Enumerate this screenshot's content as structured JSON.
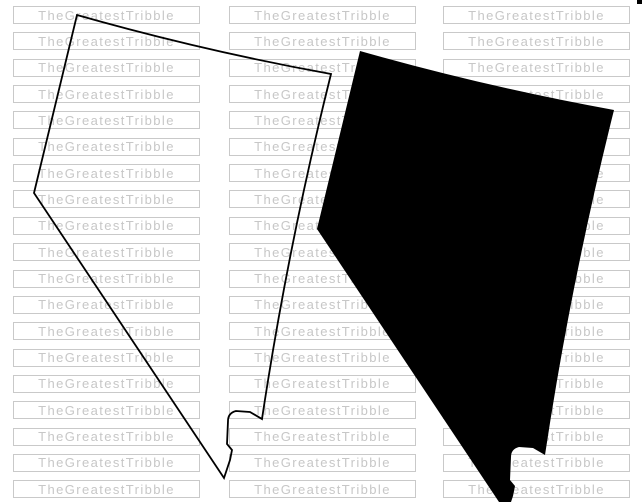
{
  "canvas": {
    "width": 642,
    "height": 502,
    "background_color": "#ffffff"
  },
  "watermark": {
    "text": "TheGreatestTribble",
    "text_color": "#c7c7c7",
    "border_color": "#c9c9c9",
    "rows": 19,
    "cols": 3,
    "col_x": [
      13,
      229,
      443
    ],
    "row_start_y": 6,
    "row_pitch": 26.35,
    "box_width": 185,
    "box_height": 16
  },
  "maps": {
    "shape_name": "nevada-state-map",
    "path": "M77,15 Q204,51 331,74 Q288,246 262,419 L250,412 L236,411 Q228,413 228,421 L227,444 L232,450 L230,460 L224,478 L34,193 Z",
    "outline": {
      "stroke_color": "#000000",
      "stroke_width": 1.8,
      "fill": "none"
    },
    "silhouette": {
      "fill_color": "#000000",
      "transform": "translate(283,36)"
    }
  },
  "corner_mark": {
    "x": 637,
    "y": 0,
    "width": 5,
    "height": 4,
    "color": "#000000"
  }
}
